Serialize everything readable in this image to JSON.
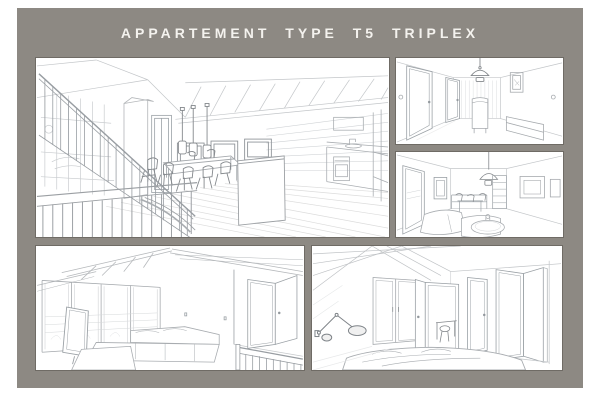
{
  "board": {
    "title": "APPARTEMENT TYPE T5 TRIPLEX",
    "colors": {
      "page_bg": "#ffffff",
      "board_bg": "#8d8983",
      "title": "#f4f2ee",
      "panel_bg": "#ffffff",
      "panel_border": "#6f6b65",
      "sketch_light": "#c9cccf",
      "sketch_mid": "#aaaeb2",
      "sketch_dark": "#84888c"
    },
    "panels": [
      {
        "name": "living-dining-kitchen-view",
        "description": "open plan living area: stair balustrade, three pendant lights over dining table, exposed rafters, kitchen island"
      },
      {
        "name": "entry-hall-view",
        "description": "hallway: two doors, dome pendant light, console, wall frame, bench"
      },
      {
        "name": "living-room-view",
        "description": "lounge: glazed door, dining corner, pendant light, artwork, sofa and round coffee table"
      },
      {
        "name": "mezzanine-lounge-view",
        "description": "mezzanine: sloped roof beams, glazed wall, corner sofa, open door, guardrail"
      },
      {
        "name": "bedroom-view",
        "description": "bedroom: wall lamp, wardrobe, open door with desk, two doors, bed in foreground"
      }
    ]
  }
}
